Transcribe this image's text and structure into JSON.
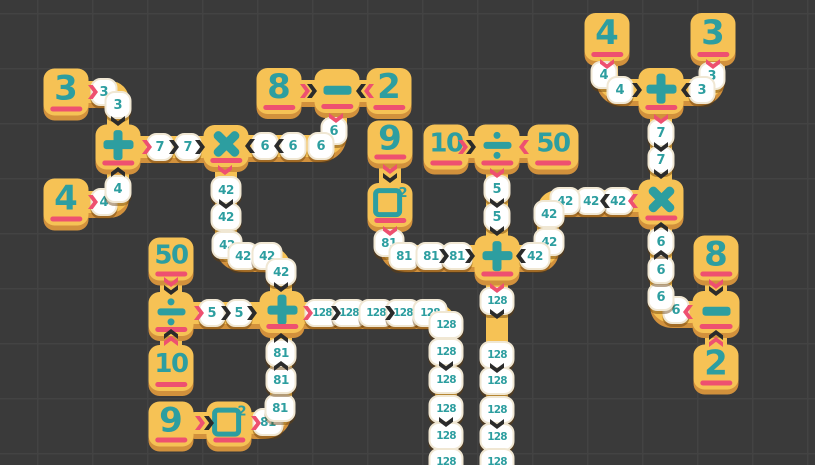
{
  "colors": {
    "bg": "#3a3a3a",
    "grid": "#434343",
    "yellow": "#f6c255",
    "amber": "#d2913c",
    "teal": "#2d9ea0",
    "pink": "#ee5070",
    "ink": "#2b2b2b",
    "tokenBorder": "#f0e7d3"
  },
  "board": {
    "tiles": [
      {
        "id": "num-3-a",
        "type": "number",
        "label": "3",
        "x": 66,
        "y": 92,
        "h": 47
      },
      {
        "id": "num-4-a",
        "type": "number",
        "label": "4",
        "x": 66,
        "y": 202,
        "h": 47
      },
      {
        "id": "op-plus-a",
        "type": "plus",
        "x": 118,
        "y": 147
      },
      {
        "id": "op-times-a",
        "type": "times",
        "x": 226,
        "y": 146,
        "h": 42
      },
      {
        "id": "num-8-a",
        "type": "number",
        "label": "8",
        "x": 279,
        "y": 91,
        "h": 46
      },
      {
        "id": "op-minus-a",
        "type": "minus",
        "x": 337,
        "y": 91,
        "h": 44
      },
      {
        "id": "num-2-a",
        "type": "number",
        "label": "2",
        "x": 389,
        "y": 91,
        "h": 46
      },
      {
        "id": "num-9-a",
        "type": "number",
        "label": "9",
        "x": 390,
        "y": 142,
        "h": 43
      },
      {
        "id": "op-square-a",
        "type": "square",
        "sup": "2",
        "x": 390,
        "y": 205,
        "h": 44
      },
      {
        "id": "num-10-a",
        "type": "number",
        "label": "10",
        "x": 446,
        "y": 147
      },
      {
        "id": "op-divide-a",
        "type": "divide",
        "x": 497,
        "y": 147
      },
      {
        "id": "num-50-a",
        "type": "number",
        "label": "50",
        "x": 553,
        "y": 147,
        "w": 51
      },
      {
        "id": "op-plus-c",
        "type": "plus",
        "x": 497,
        "y": 258
      },
      {
        "id": "num-4-b",
        "type": "number",
        "label": "4",
        "x": 607,
        "y": 37,
        "h": 48
      },
      {
        "id": "num-3-b",
        "type": "number",
        "label": "3",
        "x": 713,
        "y": 37,
        "h": 48
      },
      {
        "id": "op-plus-d",
        "type": "plus",
        "x": 661,
        "y": 91,
        "h": 46
      },
      {
        "id": "op-times-b",
        "type": "times",
        "x": 661,
        "y": 202
      },
      {
        "id": "num-8-b",
        "type": "number",
        "label": "8",
        "x": 716,
        "y": 258
      },
      {
        "id": "op-minus-b",
        "type": "minus",
        "x": 716,
        "y": 312,
        "w": 47,
        "h": 42
      },
      {
        "id": "num-2-b",
        "type": "number",
        "label": "2",
        "x": 716,
        "y": 367
      },
      {
        "id": "num-50-b",
        "type": "number",
        "label": "50",
        "x": 171,
        "y": 259,
        "h": 43
      },
      {
        "id": "op-divide-b",
        "type": "divide",
        "x": 171,
        "y": 314,
        "h": 44
      },
      {
        "id": "num-10-b",
        "type": "number",
        "label": "10",
        "x": 171,
        "y": 368,
        "h": 46
      },
      {
        "id": "op-plus-b",
        "type": "plus",
        "x": 282,
        "y": 312,
        "h": 42
      },
      {
        "id": "num-9-b",
        "type": "number",
        "label": "9",
        "x": 171,
        "y": 424
      },
      {
        "id": "op-square-b",
        "type": "square",
        "sup": "2",
        "x": 229,
        "y": 424
      }
    ],
    "paths": [
      {
        "d": "M 86 92 L 109 92 Q 118 92 118 101 L 118 127"
      },
      {
        "d": "M 86 202 L 109 202 Q 118 202 118 193 L 118 167"
      },
      {
        "d": "M 139 147 L 206 147"
      },
      {
        "d": "M 336 112 L 336 128 Q 336 146 318 146 L 247 146"
      },
      {
        "d": "M 226 166 L 226 237 Q 226 256 245 256 L 263 256 Q 281 256 281 274 L 281 294"
      },
      {
        "d": "M 390 162 L 390 185"
      },
      {
        "d": "M 390 226 L 390 239 Q 390 256 408 256 L 476 256"
      },
      {
        "d": "M 466 147 L 477 147"
      },
      {
        "d": "M 519 147 L 529 147"
      },
      {
        "d": "M 497 168 L 497 238"
      },
      {
        "d": "M 497 279 L 497 465"
      },
      {
        "d": "M 638 201 L 559 201 Q 548 201 548 212 L 548 245 Q 548 256 537 256 L 519 256"
      },
      {
        "d": "M 607 60 L 607 73 Q 607 90 624 90 L 641 90"
      },
      {
        "d": "M 714 60 L 714 73 Q 714 90 697 90 L 681 90"
      },
      {
        "d": "M 661 112 L 661 182"
      },
      {
        "d": "M 692 312 L 673 312 Q 661 312 661 300 L 661 224"
      },
      {
        "d": "M 716 279 L 716 293"
      },
      {
        "d": "M 716 347 L 716 334"
      },
      {
        "d": "M 302 91 L 316 91"
      },
      {
        "d": "M 360 91 L 368 91"
      },
      {
        "d": "M 171 279 L 171 294"
      },
      {
        "d": "M 171 335 L 171 347"
      },
      {
        "d": "M 193 313 L 262 313"
      },
      {
        "d": "M 302 313 L 430 313 Q 446 313 446 329 L 446 465"
      },
      {
        "d": "M 254 423 L 262 423 Q 281 423 281 404 L 281 333"
      },
      {
        "d": "M 195 423 L 208 423"
      }
    ],
    "tokens": [
      {
        "value": "3",
        "x": 104,
        "y": 92
      },
      {
        "value": "3",
        "x": 118,
        "y": 105
      },
      {
        "value": "4",
        "x": 104,
        "y": 202
      },
      {
        "value": "4",
        "x": 118,
        "y": 189
      },
      {
        "value": "7",
        "x": 160,
        "y": 147
      },
      {
        "value": "7",
        "x": 188,
        "y": 147
      },
      {
        "value": "6",
        "x": 334,
        "y": 131
      },
      {
        "value": "6",
        "x": 321,
        "y": 146
      },
      {
        "value": "6",
        "x": 293,
        "y": 146
      },
      {
        "value": "6",
        "x": 265,
        "y": 146
      },
      {
        "value": "42",
        "x": 226,
        "y": 190
      },
      {
        "value": "42",
        "x": 226,
        "y": 217
      },
      {
        "value": "42",
        "x": 227,
        "y": 245
      },
      {
        "value": "42",
        "x": 243,
        "y": 256
      },
      {
        "value": "42",
        "x": 267,
        "y": 256
      },
      {
        "value": "42",
        "x": 281,
        "y": 272
      },
      {
        "value": "81",
        "x": 389,
        "y": 243
      },
      {
        "value": "81",
        "x": 404,
        "y": 256
      },
      {
        "value": "81",
        "x": 431,
        "y": 256
      },
      {
        "value": "81",
        "x": 457,
        "y": 256
      },
      {
        "value": "5",
        "x": 497,
        "y": 189
      },
      {
        "value": "5",
        "x": 497,
        "y": 217
      },
      {
        "value": "42",
        "x": 618,
        "y": 201
      },
      {
        "value": "42",
        "x": 591,
        "y": 201
      },
      {
        "value": "42",
        "x": 565,
        "y": 201
      },
      {
        "value": "42",
        "x": 549,
        "y": 214
      },
      {
        "value": "42",
        "x": 549,
        "y": 242
      },
      {
        "value": "42",
        "x": 535,
        "y": 256
      },
      {
        "value": "4",
        "x": 604,
        "y": 75
      },
      {
        "value": "4",
        "x": 620,
        "y": 90
      },
      {
        "value": "3",
        "x": 712,
        "y": 76
      },
      {
        "value": "3",
        "x": 702,
        "y": 90
      },
      {
        "value": "7",
        "x": 661,
        "y": 133
      },
      {
        "value": "7",
        "x": 661,
        "y": 160
      },
      {
        "value": "6",
        "x": 676,
        "y": 310
      },
      {
        "value": "6",
        "x": 661,
        "y": 297
      },
      {
        "value": "6",
        "x": 661,
        "y": 270
      },
      {
        "value": "6",
        "x": 661,
        "y": 242
      },
      {
        "value": "5",
        "x": 212,
        "y": 313
      },
      {
        "value": "5",
        "x": 239,
        "y": 313
      },
      {
        "value": "81",
        "x": 268,
        "y": 422
      },
      {
        "value": "81",
        "x": 280,
        "y": 408
      },
      {
        "value": "81",
        "x": 281,
        "y": 380
      },
      {
        "value": "81",
        "x": 281,
        "y": 353
      },
      {
        "value": "128",
        "x": 322,
        "y": 313
      },
      {
        "value": "128",
        "x": 349,
        "y": 313
      },
      {
        "value": "128",
        "x": 376,
        "y": 313
      },
      {
        "value": "128",
        "x": 403,
        "y": 313
      },
      {
        "value": "128",
        "x": 430,
        "y": 313
      },
      {
        "value": "128",
        "x": 446,
        "y": 325
      },
      {
        "value": "128",
        "x": 446,
        "y": 352
      },
      {
        "value": "128",
        "x": 446,
        "y": 380
      },
      {
        "value": "128",
        "x": 446,
        "y": 409
      },
      {
        "value": "128",
        "x": 446,
        "y": 436
      },
      {
        "value": "128",
        "x": 446,
        "y": 462
      },
      {
        "value": "128",
        "x": 497,
        "y": 301
      },
      {
        "value": "128",
        "x": 497,
        "y": 355
      },
      {
        "value": "128",
        "x": 497,
        "y": 381
      },
      {
        "value": "128",
        "x": 497,
        "y": 410
      },
      {
        "value": "128",
        "x": 497,
        "y": 437
      },
      {
        "value": "128",
        "x": 497,
        "y": 462
      }
    ],
    "chevrons": [
      {
        "dir": "right",
        "color": "red",
        "x": 93,
        "y": 92
      },
      {
        "dir": "right",
        "color": "red",
        "x": 93,
        "y": 202
      },
      {
        "dir": "right",
        "color": "red",
        "x": 147,
        "y": 147
      },
      {
        "dir": "down",
        "color": "red",
        "x": 225,
        "y": 170
      },
      {
        "dir": "right",
        "color": "red",
        "x": 305,
        "y": 91
      },
      {
        "dir": "left",
        "color": "red",
        "x": 369,
        "y": 91
      },
      {
        "dir": "down",
        "color": "red",
        "x": 336,
        "y": 118
      },
      {
        "dir": "down",
        "color": "red",
        "x": 390,
        "y": 169
      },
      {
        "dir": "down",
        "color": "red",
        "x": 390,
        "y": 231
      },
      {
        "dir": "right",
        "color": "red",
        "x": 463,
        "y": 147
      },
      {
        "dir": "left",
        "color": "red",
        "x": 524,
        "y": 147
      },
      {
        "dir": "down",
        "color": "red",
        "x": 497,
        "y": 173
      },
      {
        "dir": "down",
        "color": "red",
        "x": 497,
        "y": 288
      },
      {
        "dir": "down",
        "color": "red",
        "x": 607,
        "y": 64
      },
      {
        "dir": "down",
        "color": "red",
        "x": 713,
        "y": 64
      },
      {
        "dir": "down",
        "color": "red",
        "x": 661,
        "y": 119
      },
      {
        "dir": "left",
        "color": "red",
        "x": 633,
        "y": 201
      },
      {
        "dir": "down",
        "color": "red",
        "x": 716,
        "y": 284
      },
      {
        "dir": "up",
        "color": "red",
        "x": 716,
        "y": 342
      },
      {
        "dir": "left",
        "color": "red",
        "x": 688,
        "y": 312
      },
      {
        "dir": "down",
        "color": "red",
        "x": 171,
        "y": 282
      },
      {
        "dir": "up",
        "color": "red",
        "x": 171,
        "y": 341
      },
      {
        "dir": "right",
        "color": "red",
        "x": 199,
        "y": 313
      },
      {
        "dir": "right",
        "color": "red",
        "x": 308,
        "y": 313
      },
      {
        "dir": "right",
        "color": "red",
        "x": 200,
        "y": 423
      },
      {
        "dir": "right",
        "color": "red",
        "x": 256,
        "y": 423
      },
      {
        "dir": "down",
        "color": "black",
        "x": 118,
        "y": 121
      },
      {
        "dir": "up",
        "color": "black",
        "x": 118,
        "y": 172
      },
      {
        "dir": "right",
        "color": "black",
        "x": 174,
        "y": 147
      },
      {
        "dir": "right",
        "color": "black",
        "x": 200,
        "y": 147
      },
      {
        "dir": "left",
        "color": "black",
        "x": 250,
        "y": 146
      },
      {
        "dir": "left",
        "color": "black",
        "x": 279,
        "y": 146
      },
      {
        "dir": "right",
        "color": "black",
        "x": 312,
        "y": 91
      },
      {
        "dir": "left",
        "color": "black",
        "x": 361,
        "y": 91
      },
      {
        "dir": "down",
        "color": "black",
        "x": 390,
        "y": 178
      },
      {
        "dir": "down",
        "color": "black",
        "x": 226,
        "y": 204
      },
      {
        "dir": "down",
        "color": "black",
        "x": 281,
        "y": 287
      },
      {
        "dir": "right",
        "color": "black",
        "x": 444,
        "y": 256
      },
      {
        "dir": "right",
        "color": "black",
        "x": 470,
        "y": 256
      },
      {
        "dir": "right",
        "color": "black",
        "x": 471,
        "y": 147
      },
      {
        "dir": "down",
        "color": "black",
        "x": 497,
        "y": 203
      },
      {
        "dir": "down",
        "color": "black",
        "x": 497,
        "y": 231
      },
      {
        "dir": "left",
        "color": "black",
        "x": 605,
        "y": 201
      },
      {
        "dir": "left",
        "color": "black",
        "x": 521,
        "y": 256
      },
      {
        "dir": "right",
        "color": "black",
        "x": 637,
        "y": 90
      },
      {
        "dir": "left",
        "color": "black",
        "x": 686,
        "y": 90
      },
      {
        "dir": "down",
        "color": "black",
        "x": 661,
        "y": 147
      },
      {
        "dir": "down",
        "color": "black",
        "x": 661,
        "y": 174
      },
      {
        "dir": "up",
        "color": "black",
        "x": 661,
        "y": 227
      },
      {
        "dir": "up",
        "color": "black",
        "x": 661,
        "y": 255
      },
      {
        "dir": "down",
        "color": "black",
        "x": 716,
        "y": 291
      },
      {
        "dir": "up",
        "color": "black",
        "x": 716,
        "y": 335
      },
      {
        "dir": "down",
        "color": "black",
        "x": 171,
        "y": 290
      },
      {
        "dir": "up",
        "color": "black",
        "x": 171,
        "y": 334
      },
      {
        "dir": "right",
        "color": "black",
        "x": 226,
        "y": 313
      },
      {
        "dir": "right",
        "color": "black",
        "x": 252,
        "y": 313
      },
      {
        "dir": "up",
        "color": "black",
        "x": 281,
        "y": 338
      },
      {
        "dir": "up",
        "color": "black",
        "x": 281,
        "y": 366
      },
      {
        "dir": "right",
        "color": "black",
        "x": 209,
        "y": 423
      },
      {
        "dir": "right",
        "color": "black",
        "x": 336,
        "y": 313
      },
      {
        "dir": "right",
        "color": "black",
        "x": 390,
        "y": 313
      },
      {
        "dir": "down",
        "color": "black",
        "x": 446,
        "y": 366
      },
      {
        "dir": "down",
        "color": "black",
        "x": 446,
        "y": 422
      },
      {
        "dir": "down",
        "color": "black",
        "x": 497,
        "y": 314
      },
      {
        "dir": "down",
        "color": "black",
        "x": 497,
        "y": 368
      },
      {
        "dir": "down",
        "color": "black",
        "x": 497,
        "y": 424
      }
    ]
  }
}
